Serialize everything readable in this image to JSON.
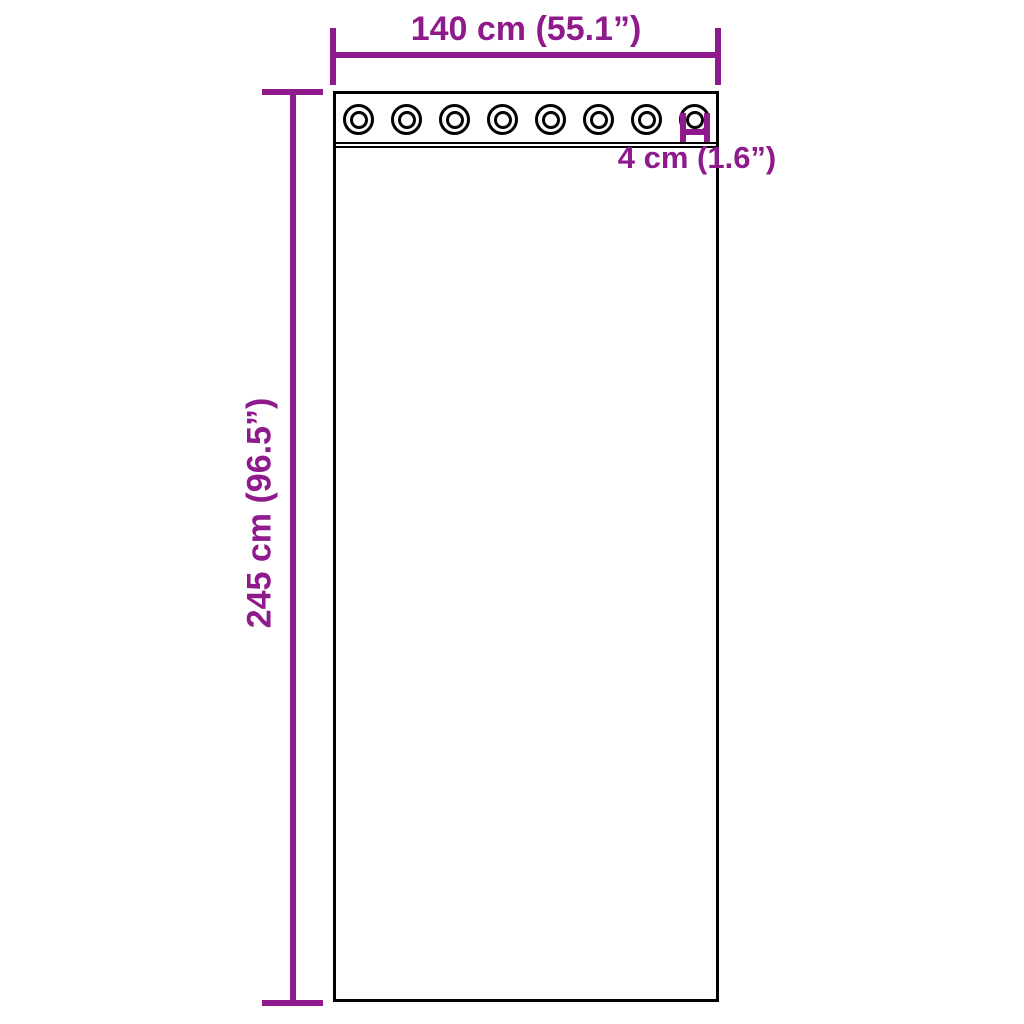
{
  "diagram": {
    "colors": {
      "dimension": "#8E1A8C",
      "outline": "#000000",
      "background": "#FFFFFF"
    },
    "curtain": {
      "grommet_count": 8
    },
    "width_dimension": {
      "label": "140 cm (55.1”)"
    },
    "height_dimension": {
      "label": "245 cm (96.5”)"
    },
    "grommet_dimension": {
      "label": "4 cm (1.6”)"
    }
  }
}
